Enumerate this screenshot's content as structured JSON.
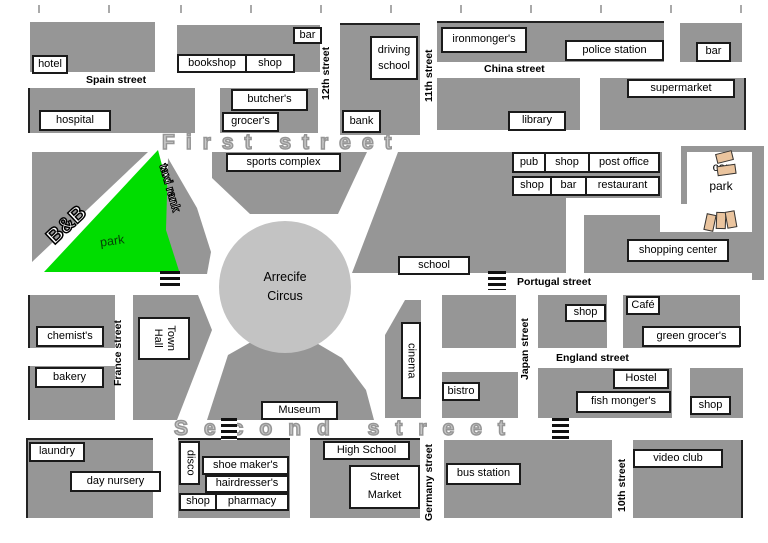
{
  "title": "town street map",
  "colors": {
    "block_gray": "#969696",
    "circus_gray": "#c3c3c3",
    "park_green": "#00dd00",
    "street_text_gray": "#c9c9c9",
    "car_tan": "#eac49e"
  },
  "streets": {
    "first": "First street",
    "second": "Second street",
    "spain": "Spain street",
    "china": "China street",
    "portugal": "Portugal street",
    "england": "England street",
    "france": "France street",
    "japan": "Japan street",
    "germany": "Germany street",
    "tenth": "10th street",
    "eleventh": "11th street",
    "twelfth": "12th street"
  },
  "circus": {
    "l1": "Arrecife",
    "l2": "Circus"
  },
  "places": {
    "hotel": "hotel",
    "bar_top_left": "bar",
    "bookshop": "bookshop",
    "shop_bookshop": "shop",
    "butchers": "butcher's",
    "grocers": "grocer's",
    "hospital": "hospital",
    "driving_l1": "driving",
    "driving_l2": "school",
    "bank": "bank",
    "ironmongers": "ironmonger's",
    "police_station": "police station",
    "bar_top_right": "bar",
    "supermarket": "supermarket",
    "library": "library",
    "bnb": "B&B",
    "park": "park",
    "taxi_rank": "taxi rank",
    "sports_complex": "sports complex",
    "pub": "pub",
    "shop_pub_row": "shop",
    "post_office": "post office",
    "shop_bar_row": "shop",
    "bar_mid": "bar",
    "restaurant": "restaurant",
    "car_park_l1": "car",
    "car_park_l2": "park",
    "shopping_center": "shopping center",
    "school": "school",
    "chemists": "chemist's",
    "bakery": "bakery",
    "town_hall_l1": "Town",
    "town_hall_l2": "Hall",
    "shop_portugal": "shop",
    "cafe": "Café",
    "green_grocers": "green grocer's",
    "hostel": "Hostel",
    "fish_mongers": "fish monger's",
    "shop_england": "shop",
    "cinema": "cinema",
    "bistro": "bistro",
    "museum": "Museum",
    "laundry": "laundry",
    "day_nursery": "day nursery",
    "disco": "disco",
    "shoe_makers": "shoe maker's",
    "hairdressers": "hairdresser's",
    "shop_disco": "shop",
    "pharmacy": "pharmacy",
    "high_school": "High School",
    "street_market_l1": "Street",
    "street_market_l2": "Market",
    "bus_station": "bus station",
    "video_club": "video club"
  }
}
